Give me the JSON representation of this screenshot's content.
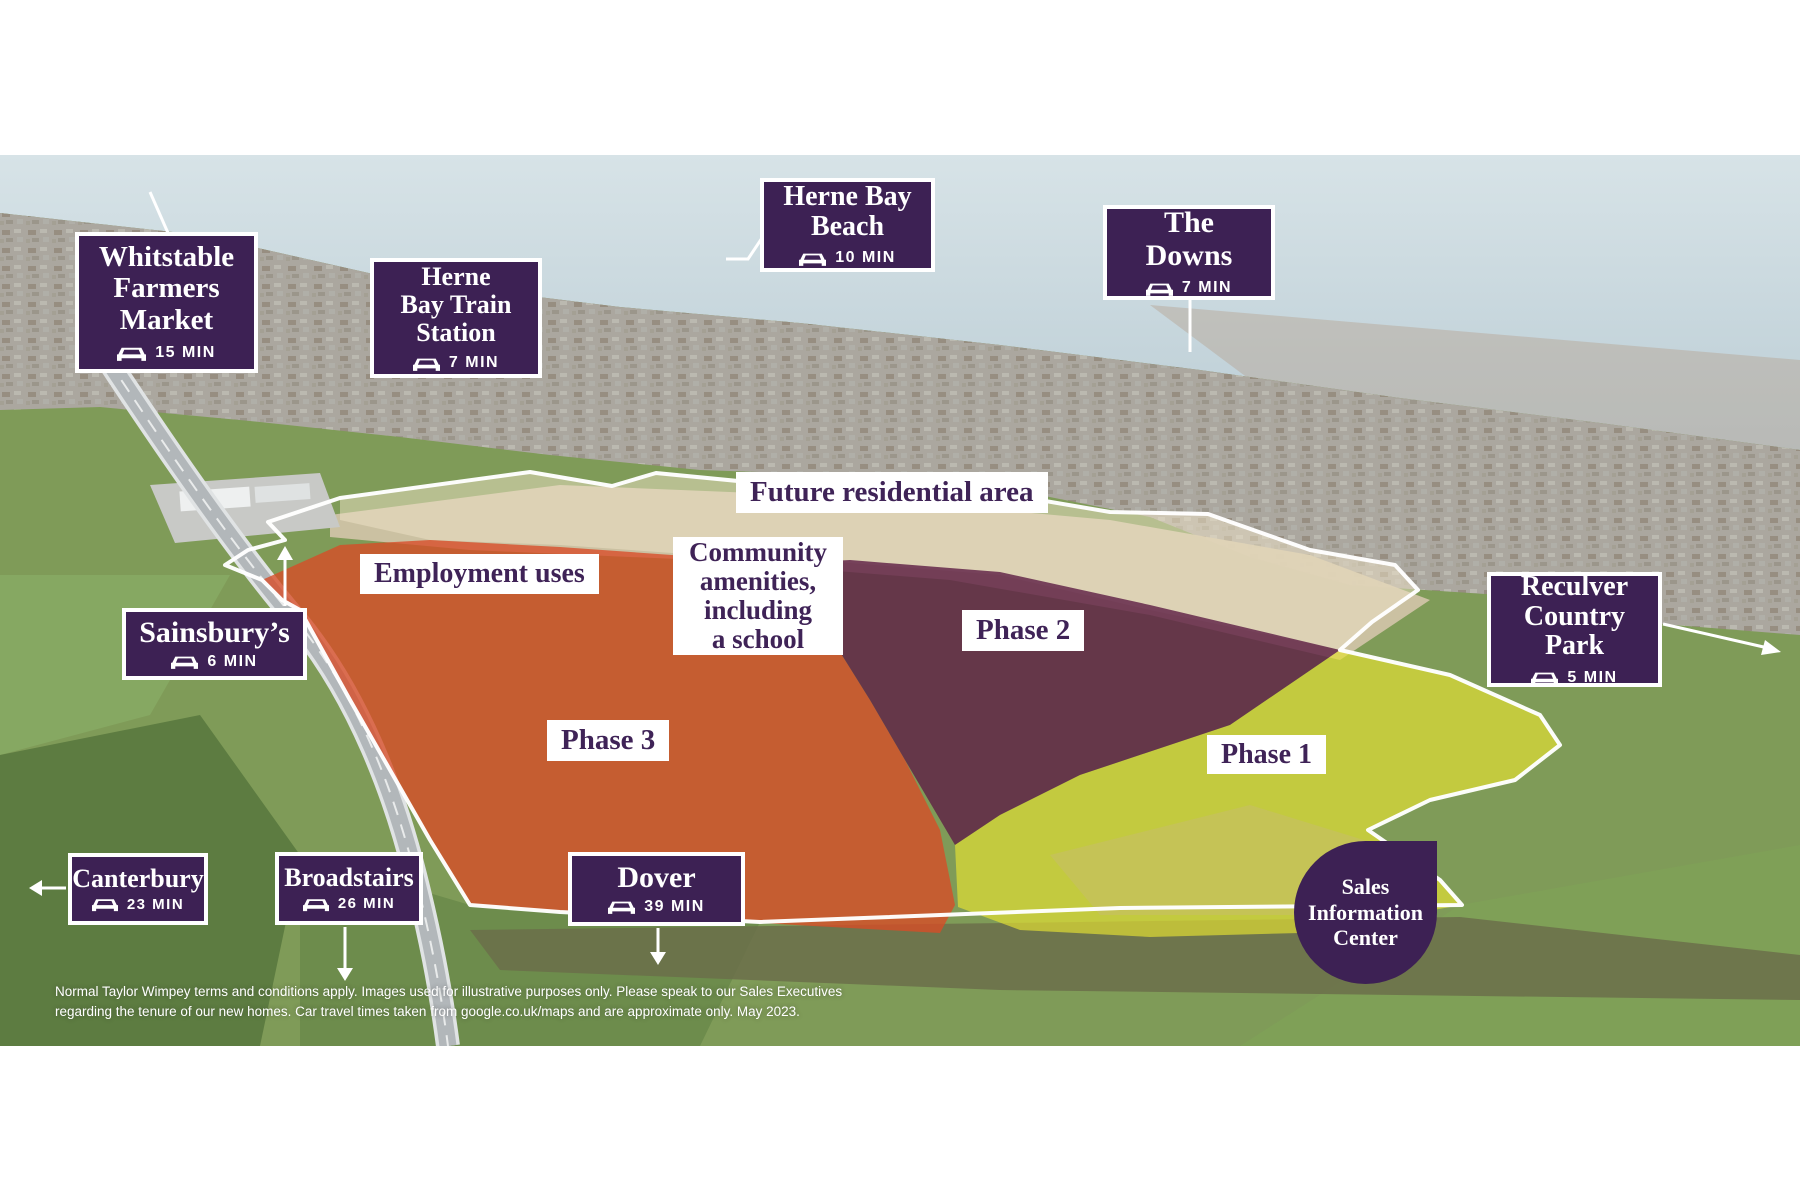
{
  "map_title_context": "New homes development aerial map, Herne Bay",
  "colors": {
    "brand_purple": "#3d2154",
    "label_text": "#ffffff",
    "area_label_text": "#3f2357",
    "phase1_overlay": "#e7e232",
    "phase2_overlay": "#5f2145",
    "phase3_overlay": "#d84b26",
    "future_area_overlay": "#efe3c8",
    "site_boundary": "#ffffff"
  },
  "labels": [
    {
      "id": "whitstable-farmers-market",
      "name": "Whitstable\nFarmers\nMarket",
      "time": "15 MIN"
    },
    {
      "id": "herne-bay-train-station",
      "name": "Herne\nBay Train\nStation",
      "time": "7 MIN"
    },
    {
      "id": "herne-bay-beach",
      "name": "Herne Bay\nBeach",
      "time": "10 MIN"
    },
    {
      "id": "the-downs",
      "name": "The\nDowns",
      "time": "7 MIN"
    },
    {
      "id": "sainsburys",
      "name": "Sainsbury’s",
      "time": "6 MIN"
    },
    {
      "id": "reculver-country-park",
      "name": "Reculver\nCountry\nPark",
      "time": "5 MIN"
    },
    {
      "id": "canterbury",
      "name": "Canterbury",
      "time": "23 MIN"
    },
    {
      "id": "broadstairs",
      "name": "Broadstairs",
      "time": "26 MIN"
    },
    {
      "id": "dover",
      "name": "Dover",
      "time": "39 MIN"
    }
  ],
  "areas": {
    "future": "Future residential area",
    "employment": "Employment uses",
    "community": "Community\namenities,\nincluding\na school",
    "phase2": "Phase 2",
    "phase3": "Phase 3",
    "phase1": "Phase 1"
  },
  "sales_center": "Sales\nInformation\nCenter",
  "disclaimer": "Normal Taylor Wimpey terms and conditions apply. Images used for illustrative purposes only. Please speak to our Sales Executives\nregarding the tenure of our new homes. Car travel times taken from google.co.uk/maps and are approximate only. May 2023."
}
